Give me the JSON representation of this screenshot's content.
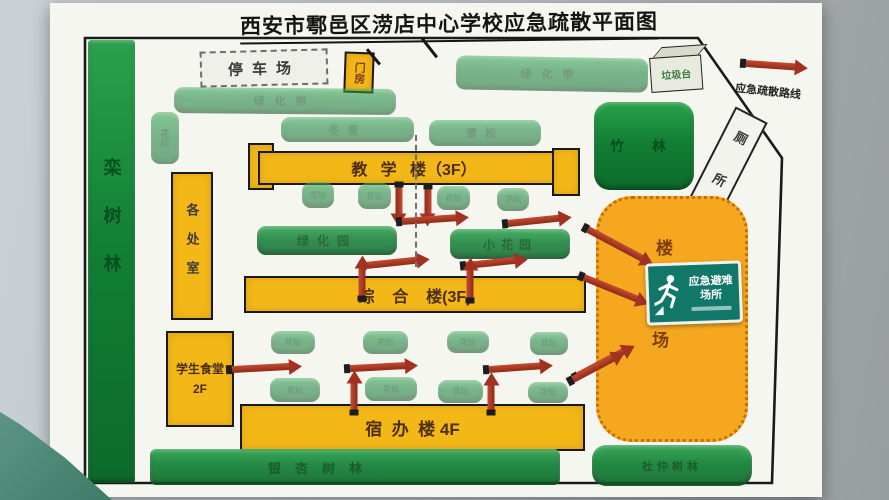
{
  "title": "西安市鄠邑区涝店中心学校应急疏散平面图",
  "legend": {
    "route_label": "应急疏散路线"
  },
  "buildings": {
    "gatehouse": "门房",
    "offices": "各处室",
    "canteen_line1": "学生食堂",
    "canteen_line2": "2F",
    "teaching": "教   学   楼（3F）",
    "comprehensive": "综    合    楼(3F)",
    "dorm": "宿  办  楼 4F"
  },
  "greenery": {
    "left_forest": "栾树林",
    "bamboo": "竹 林",
    "hedge_top": "绿化带",
    "hedge_mid_left": "冬青",
    "hedge_mid_right": "雪松",
    "hedge_top_right": "绿化带",
    "garden_left": "绿化园",
    "garden_right": "小花园",
    "flowerbed_label": "花坛",
    "bottom_forest": "银杏树林",
    "right_forest": "杜仲树林"
  },
  "facilities": {
    "parking": "停车场",
    "garbage_stand": "垃圾台",
    "toilet": "厕所"
  },
  "assembly": {
    "label_top": "楼",
    "label_bottom": "场",
    "sign_line1": "应急避难",
    "sign_line2": "场所"
  },
  "colors": {
    "building_fill": "#f4b718",
    "greenery_fill": "#128035",
    "assembly_fill": "#f5a81f",
    "arrow_red": "#a93226",
    "sign_green": "#117769"
  }
}
